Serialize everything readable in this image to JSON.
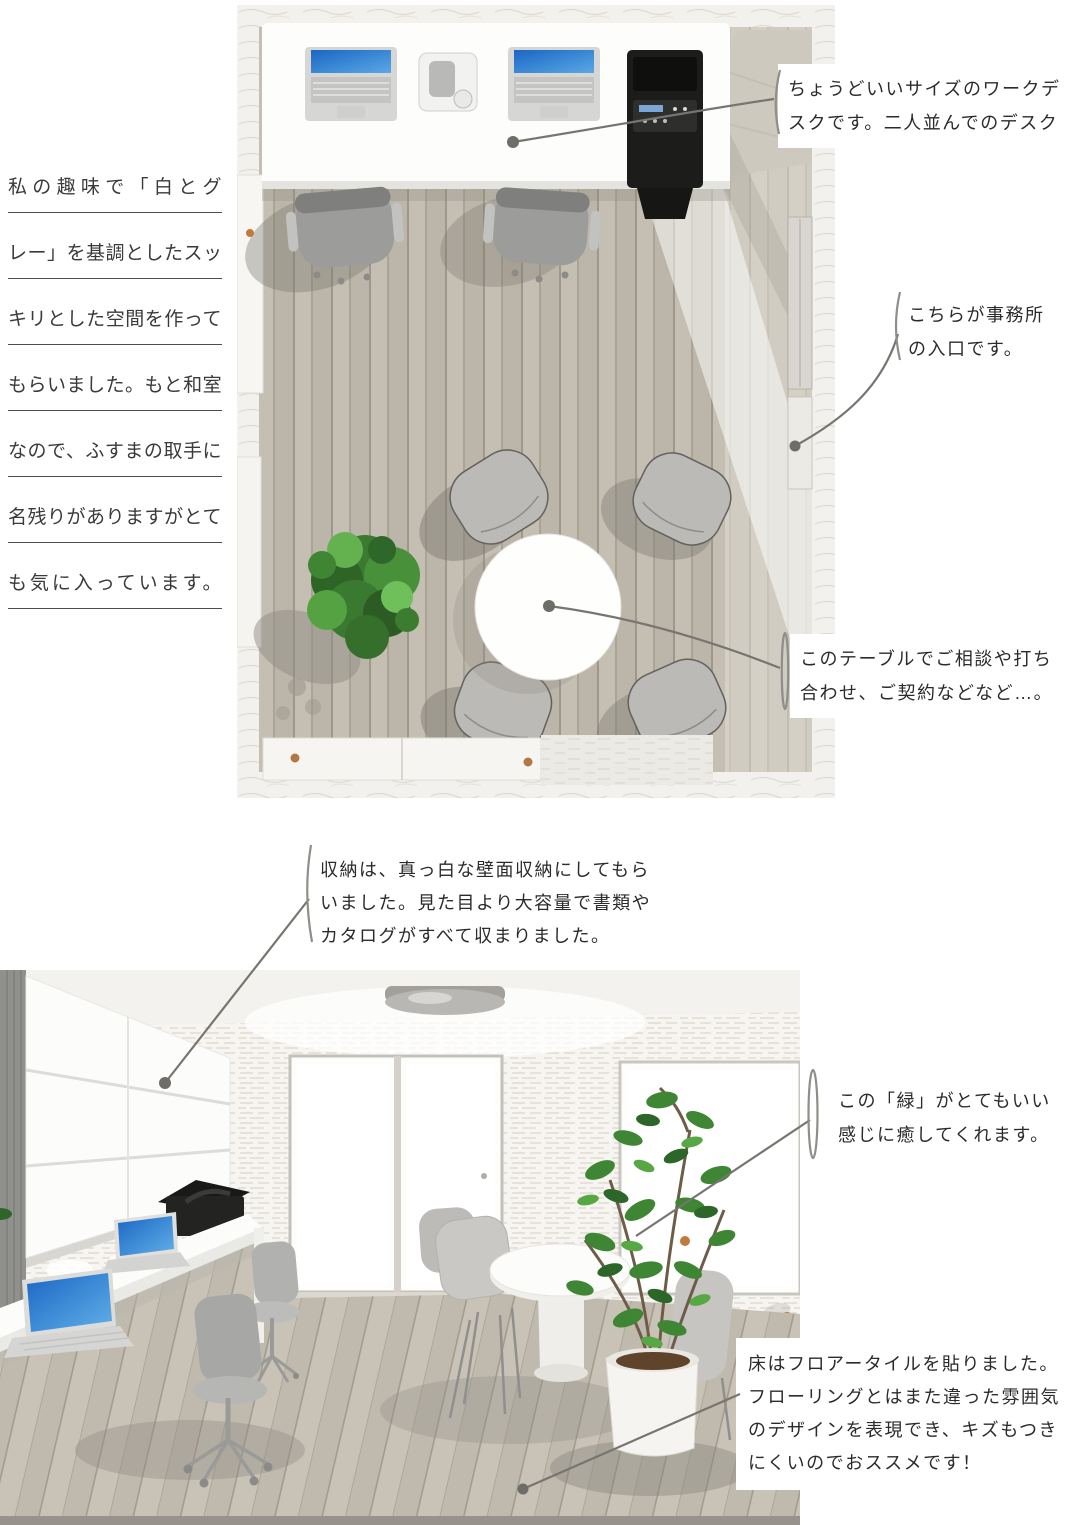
{
  "page": {
    "width": 1065,
    "height": 1525,
    "background": "#ffffff"
  },
  "left_note": {
    "lines": [
      "私の趣味で「白とグ",
      "レー」を基調としたスッ",
      "キリとした空間を作って",
      "もらいました。もと和室",
      "なので、ふすまの取手に",
      "名残りがありますがとて",
      "も気に入っています。"
    ]
  },
  "annotations": {
    "desk": {
      "lines": [
        "ちょうどいいサイズのワークデ",
        "スクです。二人並んでのデスク"
      ]
    },
    "entrance": {
      "lines": [
        "こちらが事務所",
        "の入口です。"
      ]
    },
    "meeting_table": {
      "lines": [
        "このテーブルでご相談や打ち",
        "合わせ、ご契約などなど…。"
      ]
    },
    "storage": {
      "lines": [
        "収納は、真っ白な壁面収納にしてもら",
        "いました。見た目より大容量で書類や",
        "カタログがすべて収まりました。"
      ]
    },
    "greenery": {
      "lines": [
        "この「緑」がとてもいい",
        "感じに癒してくれます。"
      ]
    },
    "floor_tile": {
      "lines": [
        "床はフロアータイルを貼りました。",
        "フローリングとはまた違った雰囲気",
        "のデザインを表現でき、キズもつき",
        "にくいのでおススメです！"
      ]
    }
  },
  "colors": {
    "text": "#2f2f2f",
    "underline": "#4d4d4d",
    "leader_line": "#76756f",
    "laptop_screen_blue": "#1d6cc6",
    "plant_green": "#3e8633",
    "fusuma_handle_brown": "#b17a44",
    "wood_floor_gray": "#c4beb3",
    "wall_white": "#f4f2ee",
    "office_chair_gray": "#9c9c9a",
    "printer_black": "#232322"
  }
}
